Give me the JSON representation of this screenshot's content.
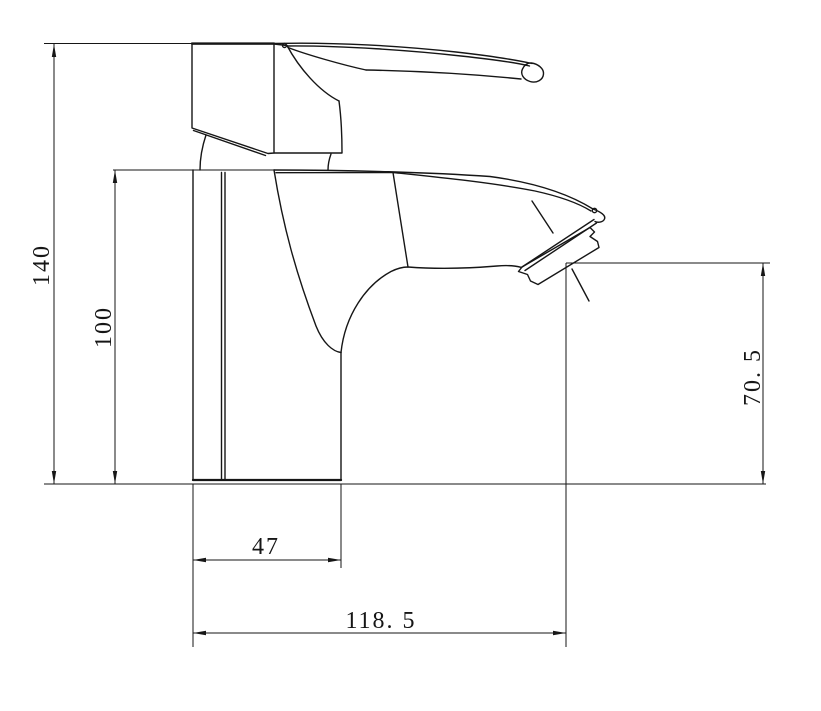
{
  "dimensions": {
    "overall_height": "140",
    "body_height": "100",
    "outlet_height": "70. 5",
    "base_width": "47",
    "spout_reach": "118. 5"
  },
  "colors": {
    "line": "#161616",
    "background": "#ffffff"
  }
}
